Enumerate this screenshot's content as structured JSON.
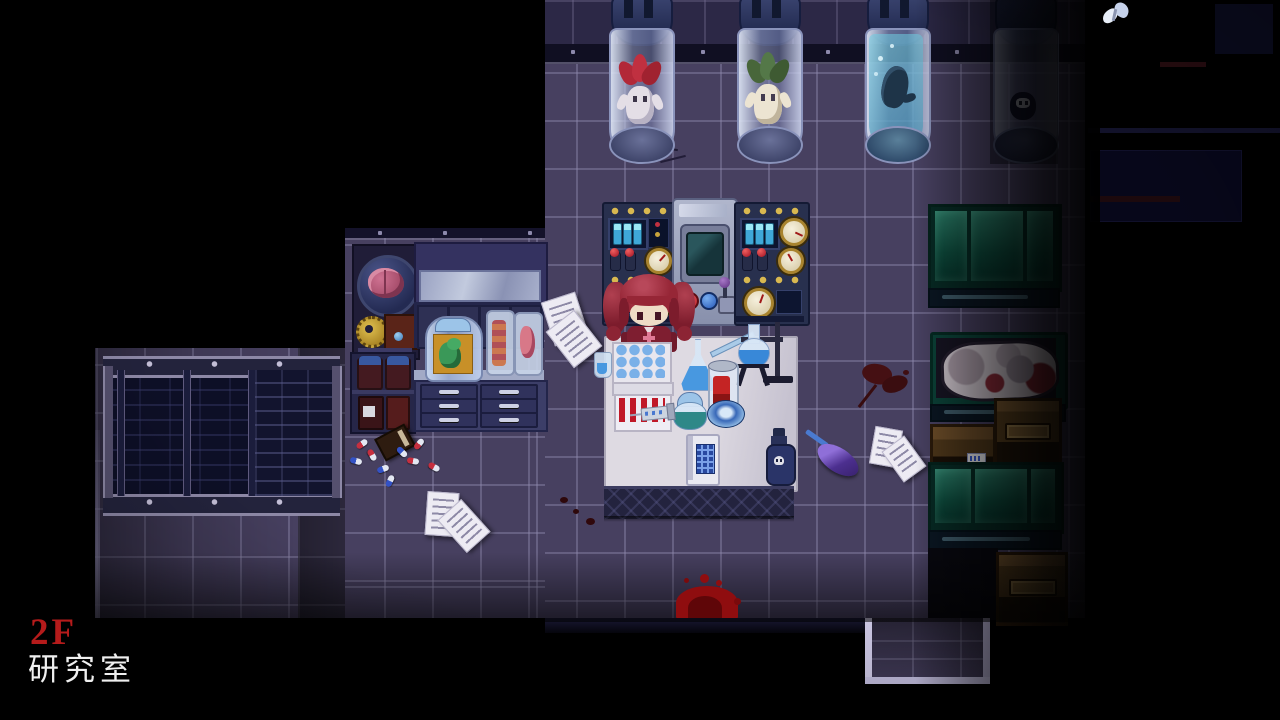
{
  "scene": {
    "game_view": "laboratory-room",
    "hud": {
      "floor_label": "2F",
      "room_label": "研究室"
    },
    "palette": {
      "void": "#000000",
      "floor_tile": "#474060",
      "floor_grout": "#928cb0",
      "wall_tile": "#2c2846",
      "table_top": "#d6d2da",
      "cabinet_teal": "#115144",
      "wood_brown": "#6b4c28",
      "blood_bright": "#9c0e10",
      "blood_dark": "#471014",
      "hud_floor_color": "#b51b1b",
      "hud_room_color": "#eeeeee"
    },
    "objects": {
      "specimen_tubes": [
        {
          "content": "mandrake-red-leaves"
        },
        {
          "content": "mandrake-green-leaves"
        },
        {
          "content": "figure-in-cyan-fluid"
        },
        {
          "content": "dark-creature"
        }
      ],
      "player": "red-twintail-girl",
      "floor_items": [
        "papers",
        "pills",
        "notebook",
        "feather-duster",
        "blood-splatter"
      ]
    }
  }
}
